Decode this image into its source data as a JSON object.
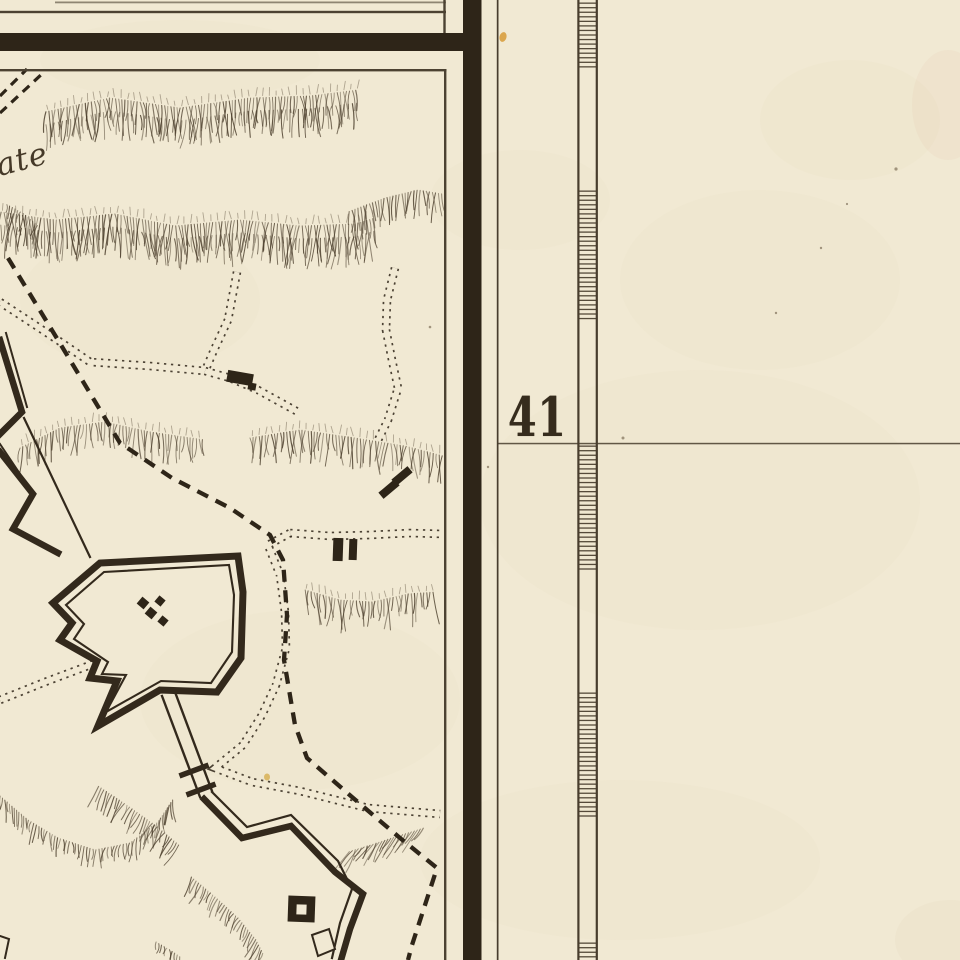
{
  "sheet": {
    "latitude_label": "41",
    "place_label_fragment": "ate",
    "colors": {
      "paper": "#f1e9d3",
      "ink_heavy": "#2e2518",
      "ink_wall": "#33291c",
      "ink_line": "#4c4232",
      "ink_hachure": "#4a3d2b",
      "ink_dots": "#3a3022",
      "ink_graticule": "#483d2d",
      "stain_orange": "#d79a36",
      "stain_yellow": "#d4aa45",
      "speck": "#6b5c44"
    }
  }
}
